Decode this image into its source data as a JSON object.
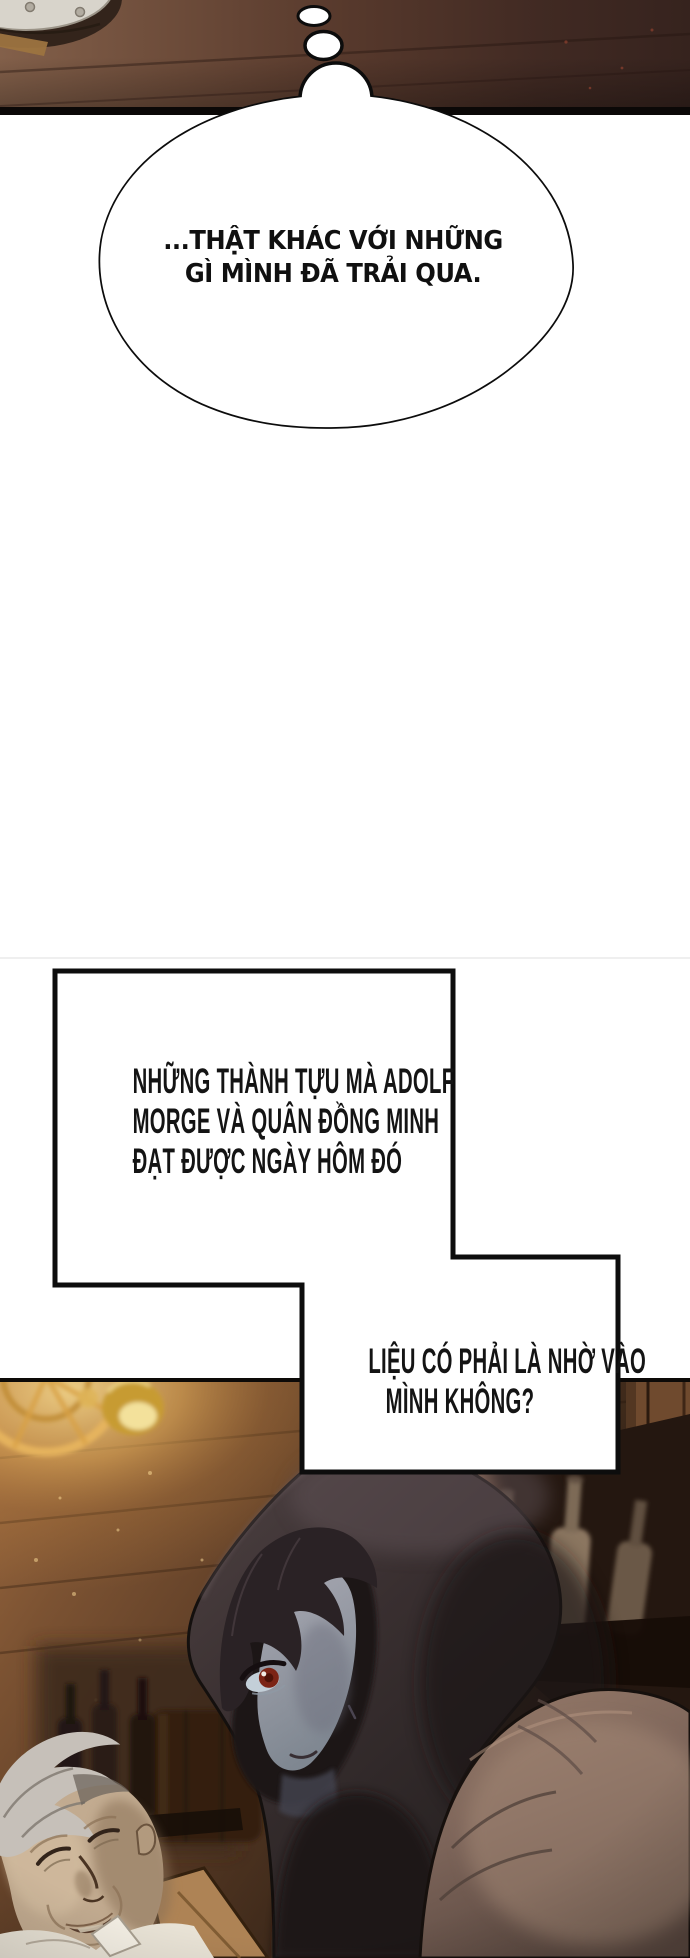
{
  "page": {
    "type": "manhwa-comic-page",
    "width_px": 690,
    "height_px": 1958,
    "background": "#ffffff"
  },
  "panel_top": {
    "description": "dark wooden table edge seen at an angle with a riveted metal plate in the top-left corner and two small thought dots leading down to a thought bubble",
    "wood_color": "#57392c",
    "border_color": "#0b0807"
  },
  "thought_bubble": {
    "lines": [
      "...THẬT KHÁC VỚI NHỮNG",
      "GÌ MÌNH ĐÃ TRẢI QUA."
    ],
    "fill": "#ffffff",
    "stroke": "#0c0c0c"
  },
  "narration_boxes": {
    "box1_lines": [
      "NHỮNG THÀNH TỰU MÀ ADOLF",
      "MORGE VÀ QUÂN ĐỒNG MINH",
      "ĐẠT ĐƯỢC NGÀY HÔM ĐÓ"
    ],
    "box2_lines": [
      "LIỆU CÓ PHẢI LÀ NHỜ VÀO",
      "MÌNH KHÔNG?"
    ],
    "fill": "#ffffff",
    "stroke": "#0d0d0d",
    "text_color": "#141414"
  },
  "panel_bottom": {
    "description": "tavern interior: golden wheel chandelier and glowing lamp top-left, dark shelf of bottles on the right, hooded figure with pale face and one red eye in the center, sleeping gray-haired old man in a white shirt at bottom-left",
    "palette": {
      "wood_light": "#a06c40",
      "wood_dark": "#281b13",
      "lamp_glow": "#f6d98e",
      "hood": "#392f30",
      "face": "#8f919c",
      "eye_red": "#7c2415",
      "old_man_skin": "#c2ab90",
      "old_man_hair": "#c6c0b9",
      "shirt": "#e8e2d5"
    }
  }
}
